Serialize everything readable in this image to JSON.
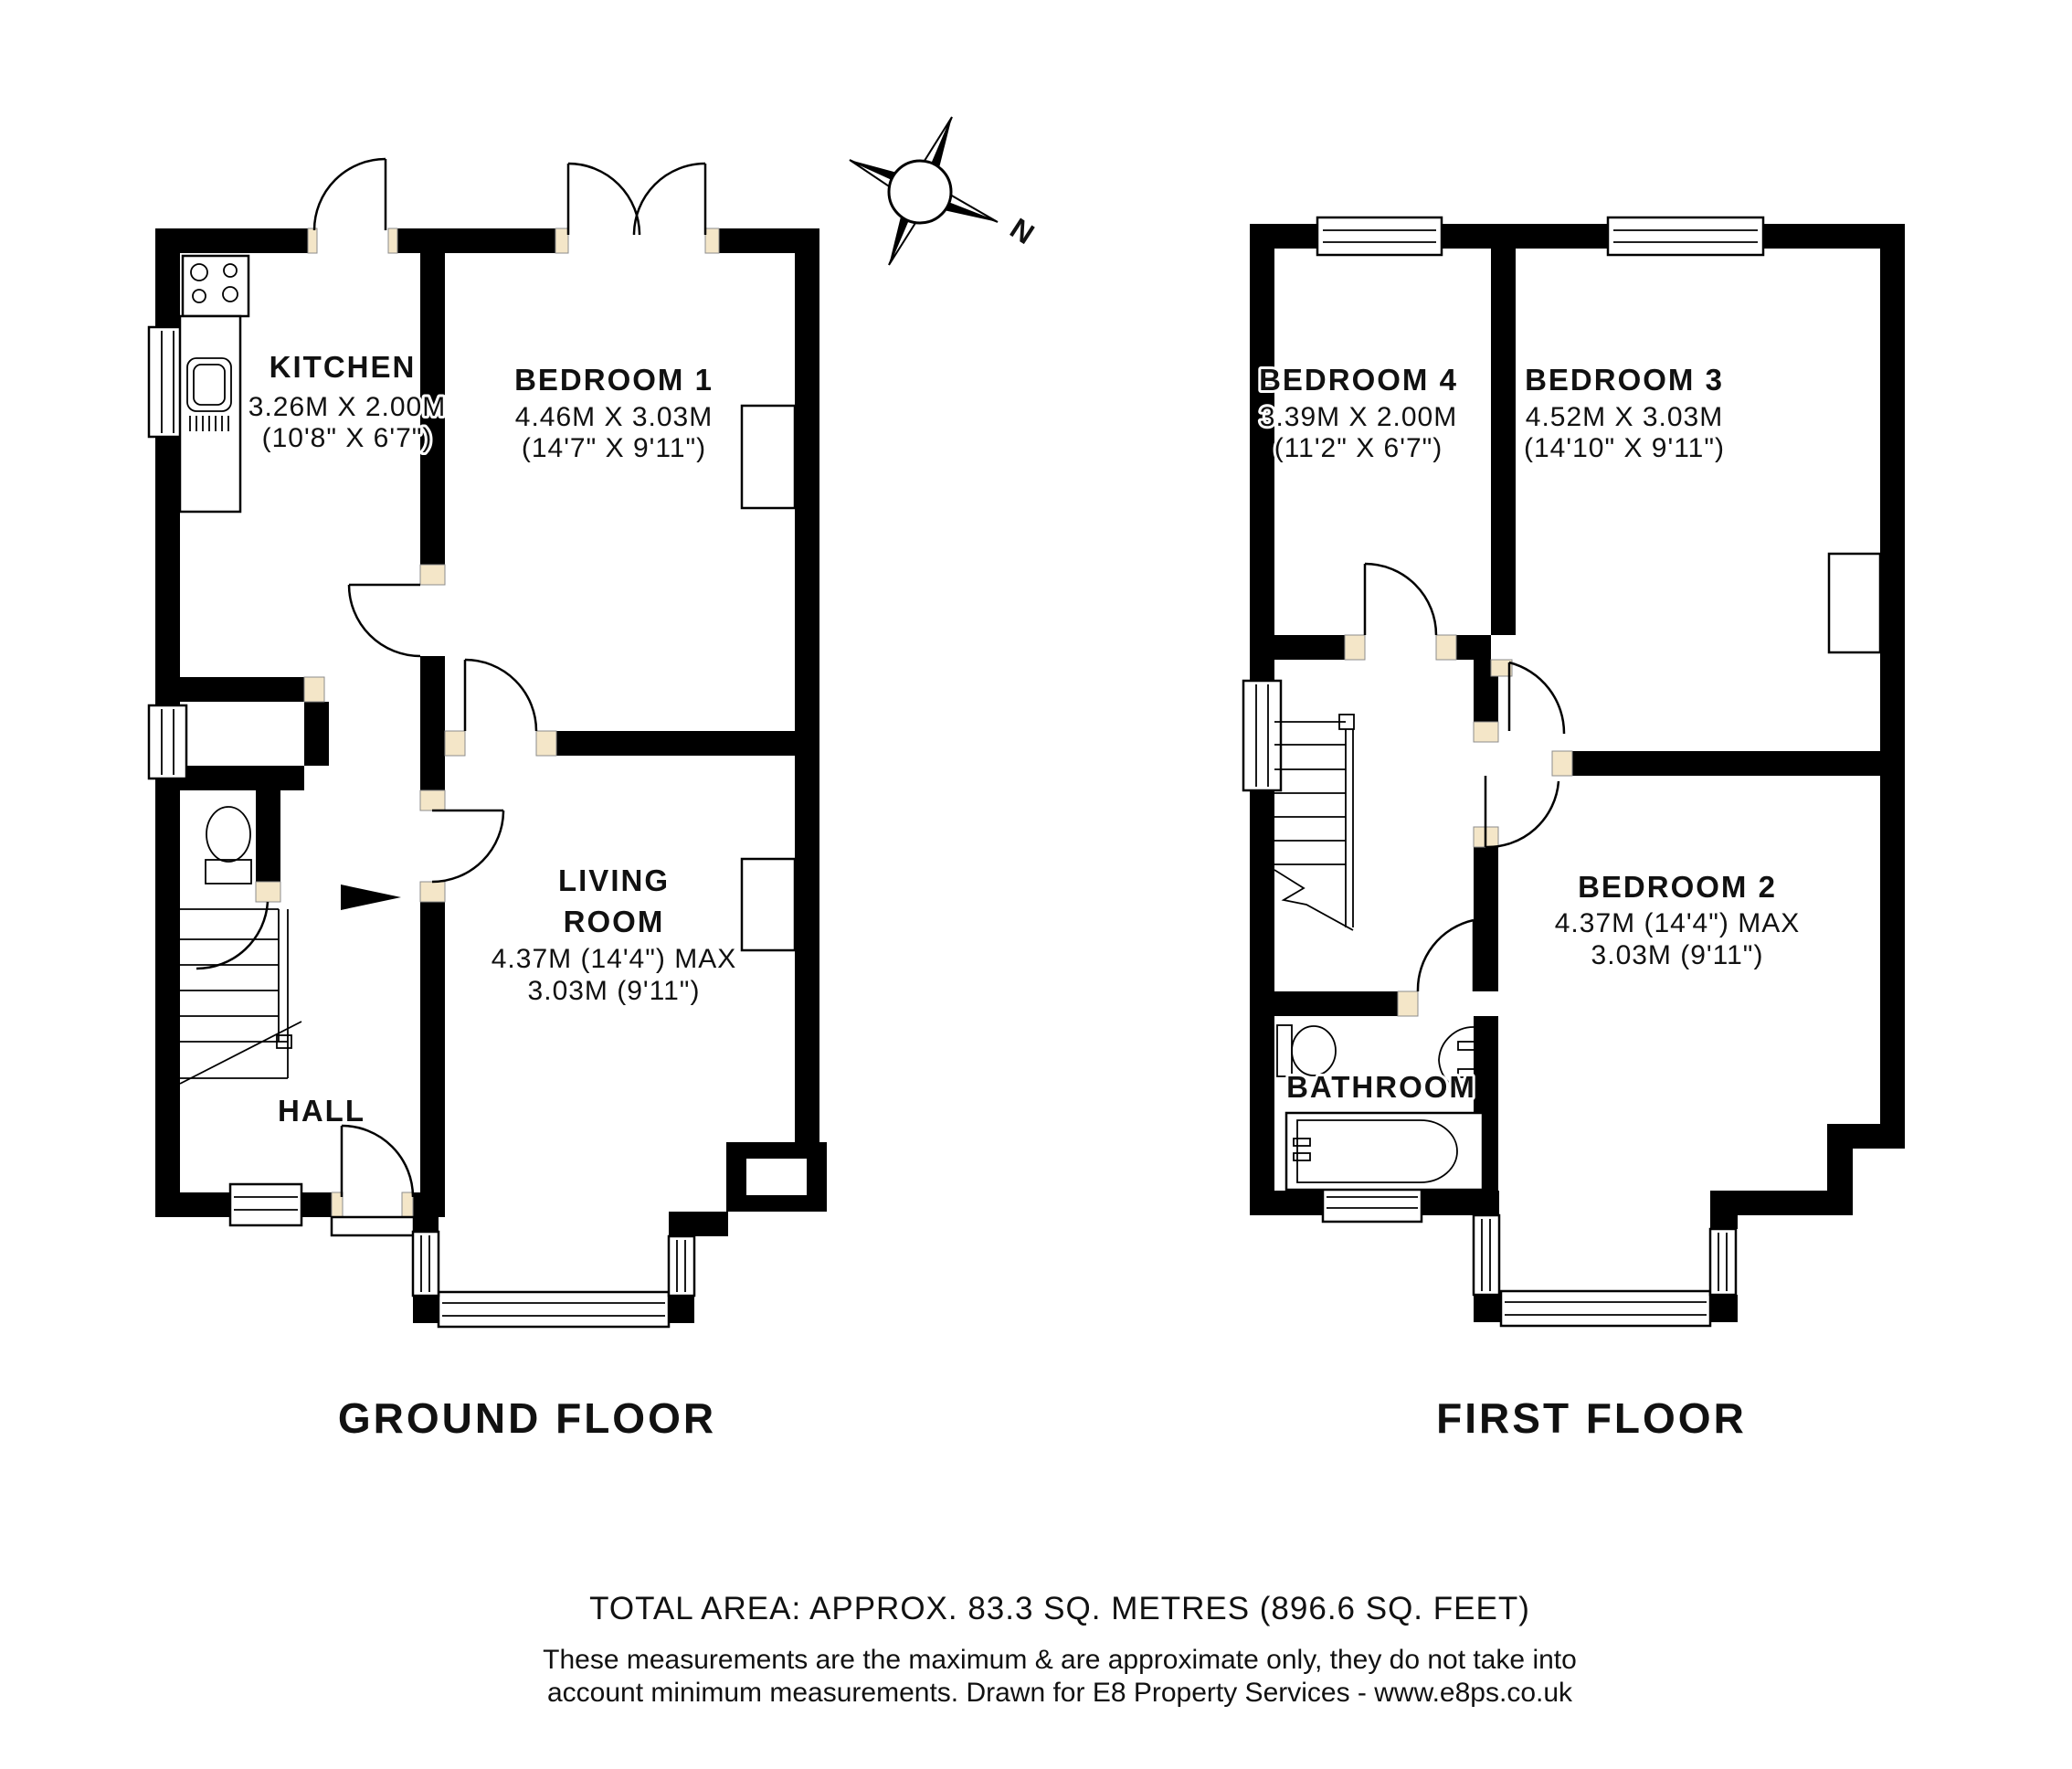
{
  "image": {
    "kind": "floor-plan",
    "background": "#ffffff",
    "wall_color": "#000000",
    "door_jamb_color": "#f4e6c8",
    "text_color": "#111111"
  },
  "ground_floor": {
    "title": "GROUND FLOOR",
    "rooms": [
      {
        "id": "kitchen",
        "name": "KITCHEN",
        "dim1": "3.26M X 2.00M",
        "dim2": "(10'8\" X 6'7\")"
      },
      {
        "id": "bedroom-1",
        "name": "BEDROOM 1",
        "dim1": "4.46M X 3.03M",
        "dim2": "(14'7\" X 9'11\")"
      },
      {
        "id": "living-room",
        "name": "LIVING",
        "name2": "ROOM",
        "dim1": "4.37M (14'4\") MAX",
        "dim2": "3.03M (9'11\")"
      },
      {
        "id": "hall",
        "name": "HALL"
      }
    ]
  },
  "first_floor": {
    "title": "FIRST FLOOR",
    "rooms": [
      {
        "id": "bedroom-4",
        "name": "BEDROOM 4",
        "dim1": "3.39M X 2.00M",
        "dim2": "(11'2\" X 6'7\")"
      },
      {
        "id": "bedroom-3",
        "name": "BEDROOM 3",
        "dim1": "4.52M X 3.03M",
        "dim2": "(14'10\" X 9'11\")"
      },
      {
        "id": "bedroom-2",
        "name": "BEDROOM 2",
        "dim1": "4.37M (14'4\") MAX",
        "dim2": "3.03M (9'11\")"
      },
      {
        "id": "bathroom",
        "name": "BATHROOM"
      }
    ]
  },
  "compass": {
    "label": "N"
  },
  "footer": {
    "total_area": "TOTAL AREA: APPROX.  83.3 SQ. METRES (896.6 SQ. FEET)",
    "disclaimer1": "These measurements are the maximum & are approximate only, they do not take into",
    "disclaimer2": "account minimum measurements. Drawn for E8 Property Services - www.e8ps.co.uk"
  }
}
